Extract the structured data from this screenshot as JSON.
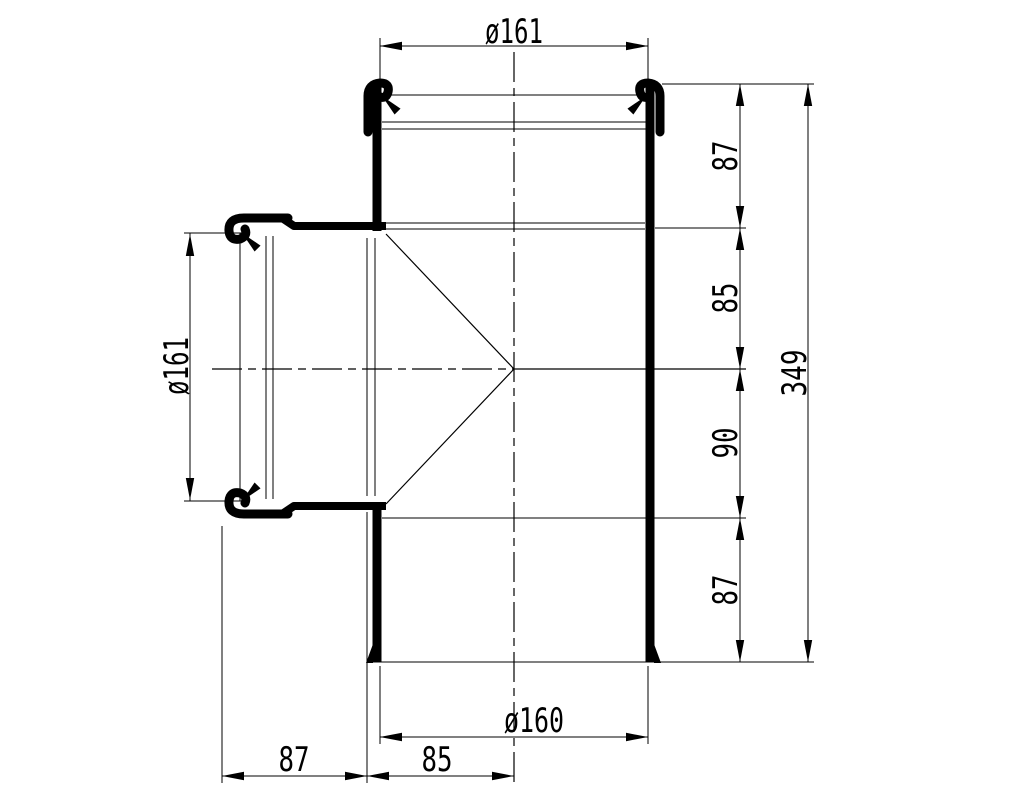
{
  "canvas": {
    "width": 1017,
    "height": 791,
    "background_color": "#ffffff",
    "line_color": "#000000"
  },
  "drawing": {
    "subject": "pipe-tee-fitting-section-view",
    "dimensions": {
      "top_socket_diameter": "ø161",
      "branch_socket_diameter": "ø161",
      "pipe_outer_diameter": "ø160",
      "overall_length": "349",
      "right_segments": {
        "top": "87",
        "upper_middle": "85",
        "lower_middle": "90",
        "bottom": "87"
      },
      "bottom_segments": {
        "left": "87",
        "right": "85"
      }
    }
  }
}
